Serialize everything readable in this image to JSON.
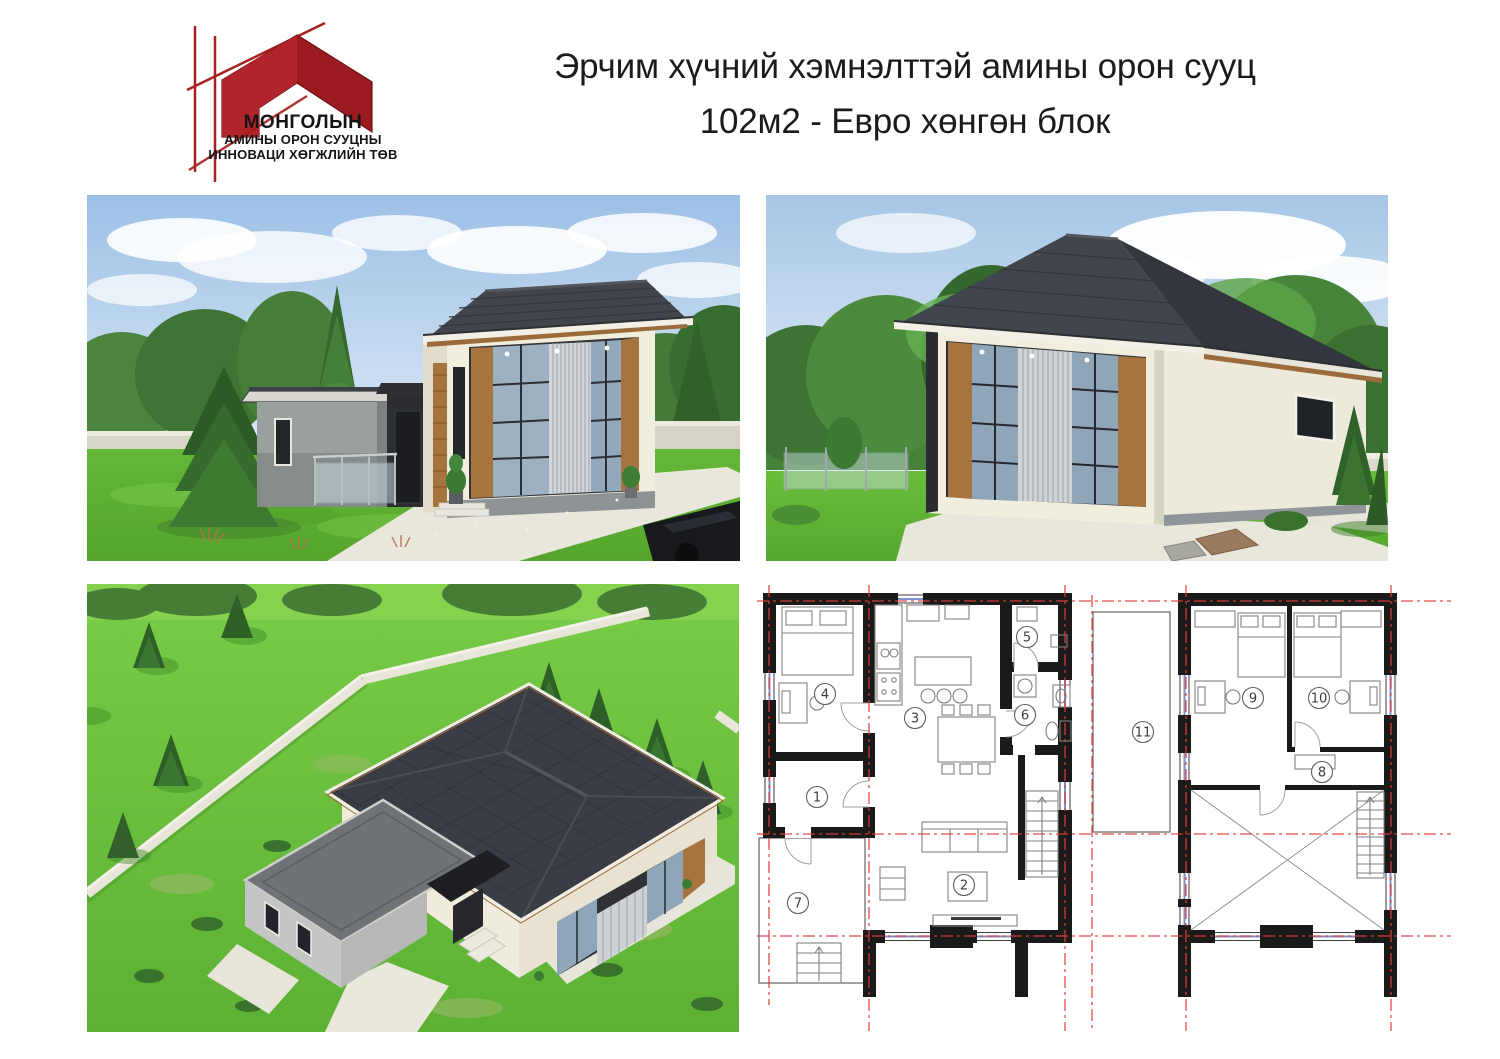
{
  "header": {
    "logo": {
      "line1": "МОНГОЛЫН",
      "line2": "АМИНЫ ОРОН СУУЦНЫ",
      "line3": "ИННОВАЦИ ХӨГЖЛИЙН ТӨВ"
    },
    "title": {
      "line1": "Эрчим хүчний хэмнэлттэй амины орон сууц",
      "line2": "102м2 - Евро хөнгөн блок"
    }
  },
  "floorplans": {
    "first_floor": {
      "rooms": [
        "1",
        "2",
        "3",
        "4",
        "5",
        "6",
        "7"
      ]
    },
    "second_floor": {
      "rooms": [
        "8",
        "9",
        "10",
        "11"
      ]
    }
  },
  "colors": {
    "brand_red": "#a5201f",
    "title_text": "#1b1b1b",
    "plan_axis_red": "#e23d38",
    "plan_wall_black": "#1a1a1a",
    "roof_dark": "#3e424a",
    "wall_cream": "#f1eede",
    "wood_brown": "#a6753f",
    "grass_green": "#63b838",
    "sky_blue": "#a3c4e6"
  }
}
